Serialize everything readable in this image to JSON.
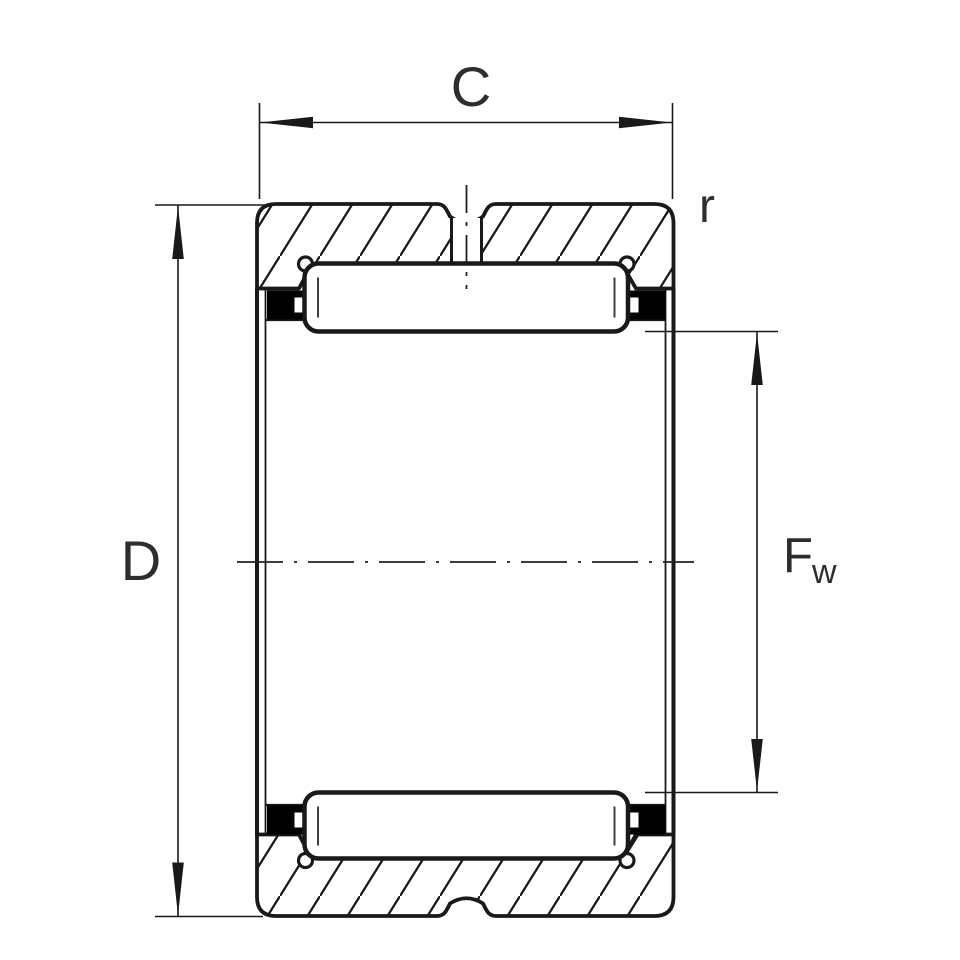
{
  "title": "Needle roller bearing cross-section technical drawing",
  "labels": {
    "width_dim": "C",
    "outer_diameter_dim": "D",
    "bore_diameter_main": "F",
    "bore_diameter_sub": "w",
    "chamfer_radius": "r"
  },
  "colors": {
    "background": "#ffffff",
    "line": "#191919",
    "text": "#2e2e2e",
    "cage_fill": "#000000",
    "roller_fill": "#ffffff"
  }
}
